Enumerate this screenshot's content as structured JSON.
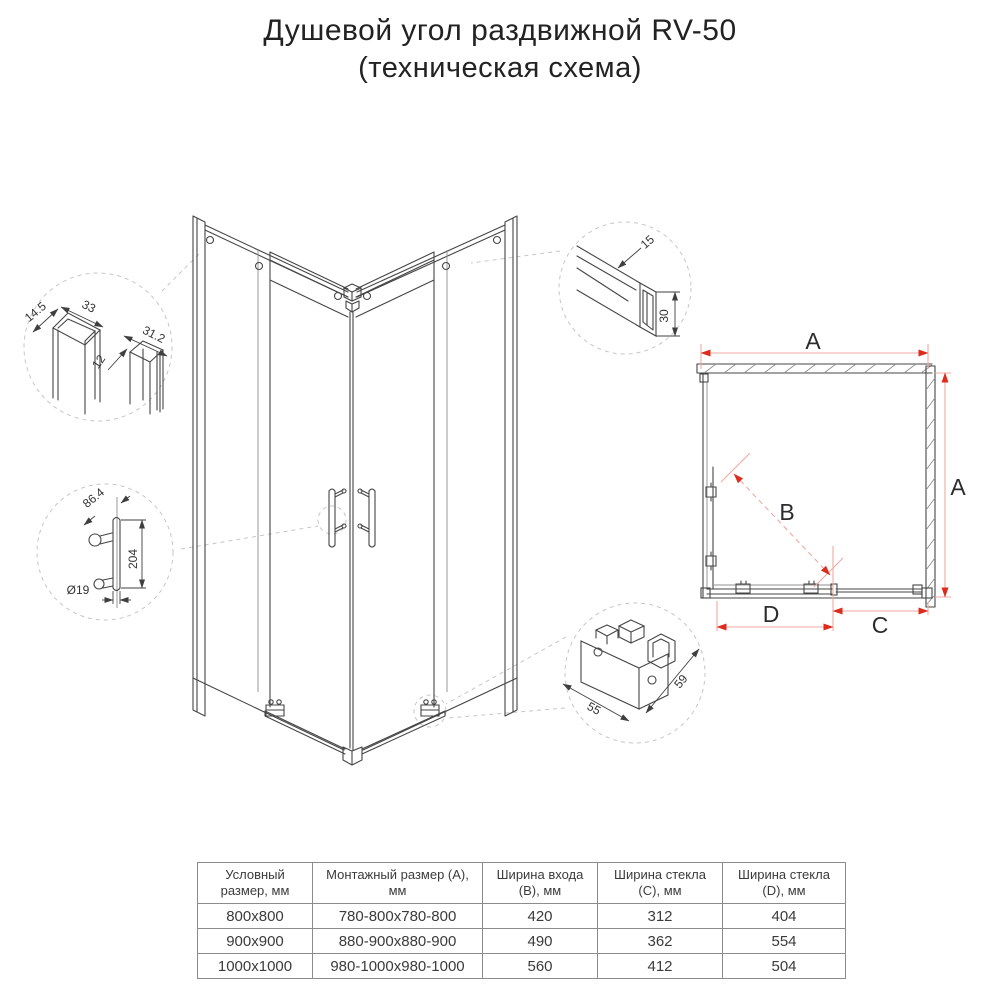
{
  "page": {
    "title_line1": "Душевой угол раздвижной RV-50",
    "title_line2": "(техническая схема)"
  },
  "plan": {
    "width_label": "A",
    "height_label": "A",
    "diagonal_label": "B",
    "glass_width_label": "C",
    "door_width_label": "D"
  },
  "details": {
    "wall_profile": {
      "d_width": "14.5",
      "d_depth": "33",
      "d_door_profile": "31.2",
      "d_gap": "12"
    },
    "handle": {
      "d_offset": "86.4",
      "d_length": "204",
      "d_diameter": "Ø19"
    },
    "top_rail": {
      "d_width": "15",
      "d_height": "30"
    },
    "bottom_bracket": {
      "d_width": "55",
      "d_depth": "59"
    }
  },
  "colors": {
    "dimension_arrow_red": "#dd2b1c",
    "dimension_line_pink": "#f0a9a2",
    "drawing_line": "#454545"
  },
  "table": {
    "headers": [
      "Условный размер, мм",
      "Монтажный размер (А), мм",
      "Ширина входа (B), мм",
      "Ширина стекла (C), мм",
      "Ширина стекла (D), мм"
    ],
    "rows": [
      [
        "800х800",
        "780-800х780-800",
        "420",
        "312",
        "404"
      ],
      [
        "900х900",
        "880-900х880-900",
        "490",
        "362",
        "554"
      ],
      [
        "1000х1000",
        "980-1000х980-1000",
        "560",
        "412",
        "504"
      ]
    ]
  }
}
